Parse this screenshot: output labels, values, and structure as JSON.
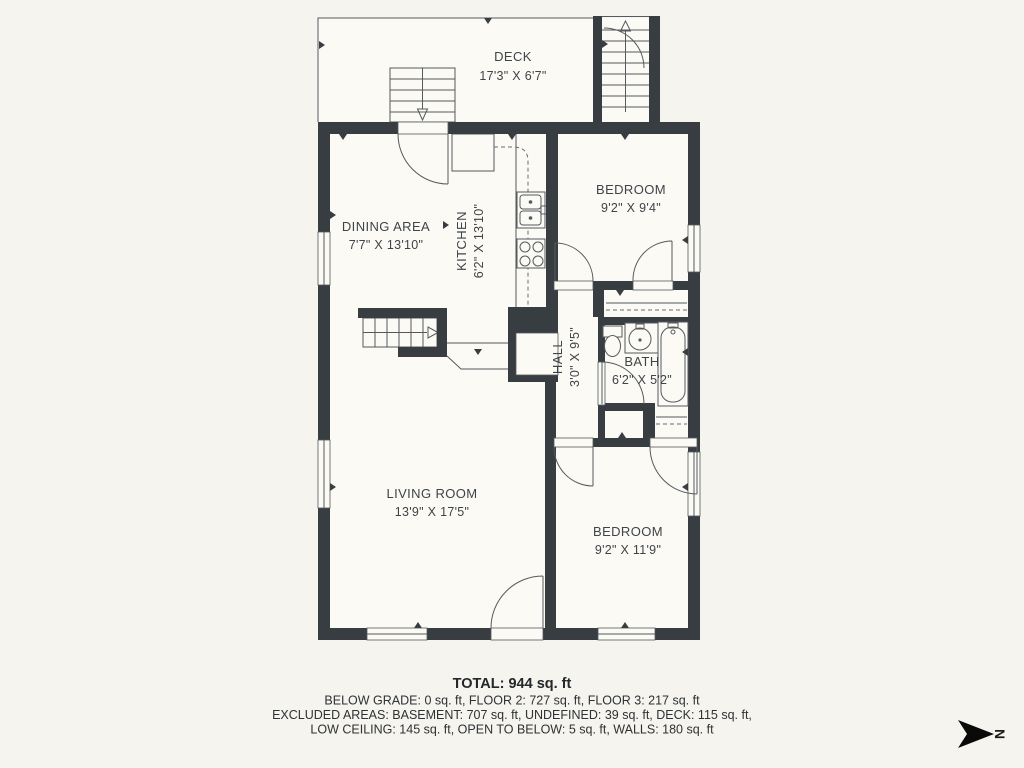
{
  "rooms": {
    "deck": {
      "name": "DECK",
      "dims": "17'3\" X 6'7\""
    },
    "dining": {
      "name": "DINING AREA",
      "dims": "7'7\" X 13'10\""
    },
    "kitchen": {
      "name": "KITCHEN",
      "dims": "6'2\" X 13'10\""
    },
    "bedroom1": {
      "name": "BEDROOM",
      "dims": "9'2\" X 9'4\""
    },
    "hall": {
      "name": "HALL",
      "dims": "3'0\" X 9'5\""
    },
    "bath": {
      "name": "BATH",
      "dims": "6'2\" X 5'2\""
    },
    "living": {
      "name": "LIVING ROOM",
      "dims": "13'9\" X 17'5\""
    },
    "bedroom2": {
      "name": "BEDROOM",
      "dims": "9'2\" X 11'9\""
    }
  },
  "footer": {
    "total": "TOTAL: 944 sq. ft",
    "line1": "BELOW GRADE: 0 sq. ft, FLOOR 2: 727 sq. ft, FLOOR 3: 217 sq. ft",
    "line2": "EXCLUDED AREAS: BASEMENT: 707 sq. ft, UNDEFINED: 39 sq. ft, DECK: 115 sq. ft,",
    "line3": "LOW CEILING: 145 sq. ft, OPEN TO BELOW: 5 sq. ft, WALLS: 180 sq. ft"
  },
  "compass": {
    "label": "N"
  },
  "colors": {
    "wall": "#383d41",
    "background": "#f5f4ee",
    "floor": "#fbfaf5",
    "line": "#565a5e",
    "text": "#3f4448",
    "footer_text": "#2e3234",
    "compass": "#0a0a0a"
  }
}
